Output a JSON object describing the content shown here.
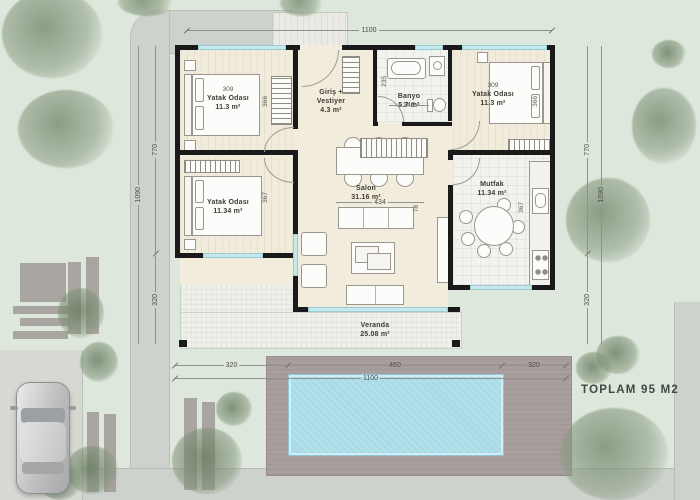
{
  "site": {
    "total_label": "TOPLAM 95 M2"
  },
  "rooms": {
    "bedroom_top_left": {
      "name": "Yatak Odası",
      "area": "11.3 m²"
    },
    "entry": {
      "name": "Giriş + Vestiyer",
      "area": "4.3 m²"
    },
    "bathroom": {
      "name": "Banyo",
      "area": "5.7 m²"
    },
    "bedroom_top_right": {
      "name": "Yatak Odası",
      "area": "11.3 m²"
    },
    "bedroom_left": {
      "name": "Yatak Odası",
      "area": "11.34 m²"
    },
    "living_room": {
      "name": "Salon",
      "area": "31.16 m²"
    },
    "kitchen": {
      "name": "Mutfak",
      "area": "11.34 m²"
    },
    "veranda": {
      "name": "Veranda",
      "area": "25.08 m²"
    }
  },
  "dimensions": {
    "top_total": "1100",
    "left": {
      "upper": "770",
      "total": "1090",
      "lower": "320"
    },
    "right": {
      "upper": "770",
      "total": "1090",
      "lower": "320"
    },
    "bottom": {
      "left": "320",
      "center": "460",
      "right": "320",
      "total": "1100"
    },
    "interior": {
      "bedroom_top_left_w": "309",
      "bedroom_top_left_h": "366",
      "bedroom_top_right_w": "309",
      "bedroom_top_right_h": "366",
      "bedroom_left_h": "367",
      "bathroom_h": "235",
      "bathroom_w": "243",
      "living_w": "434",
      "living_d": "78",
      "kitchen_h": "367"
    }
  },
  "colors": {
    "pool": "#a9dbe7",
    "deck": "#a89e9d",
    "grass": "#dde7db",
    "wall": "#1a1a1b",
    "floor": "#f2ecdd",
    "window": "#c7e9ee"
  }
}
